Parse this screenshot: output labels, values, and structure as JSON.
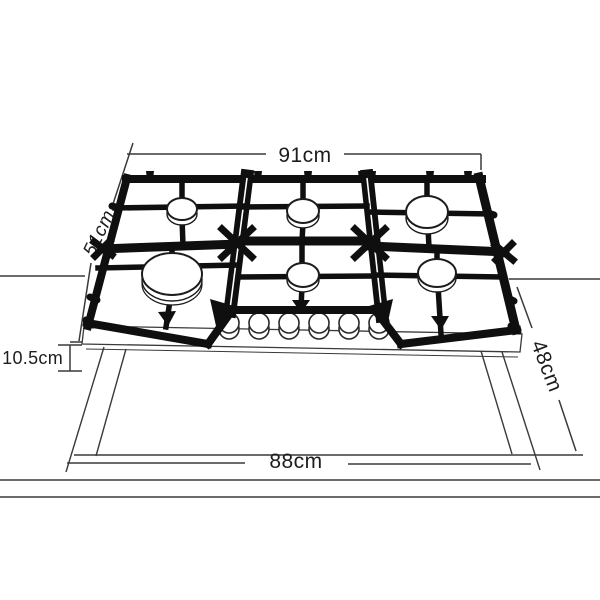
{
  "diagram": {
    "type": "installation-dimension-drawing",
    "product": "6-burner gas cooktop on countertop with cutout",
    "burner_count": 6,
    "knob_count": 6,
    "dimensions": {
      "cooktop_width": "91cm",
      "cooktop_depth": "51cm",
      "body_height": "10.5cm",
      "cutout_depth": "48cm",
      "cutout_width": "88cm"
    },
    "colors": {
      "line": "#3a3a3a",
      "grate": "#0f0f0f",
      "background": "#ffffff"
    }
  }
}
